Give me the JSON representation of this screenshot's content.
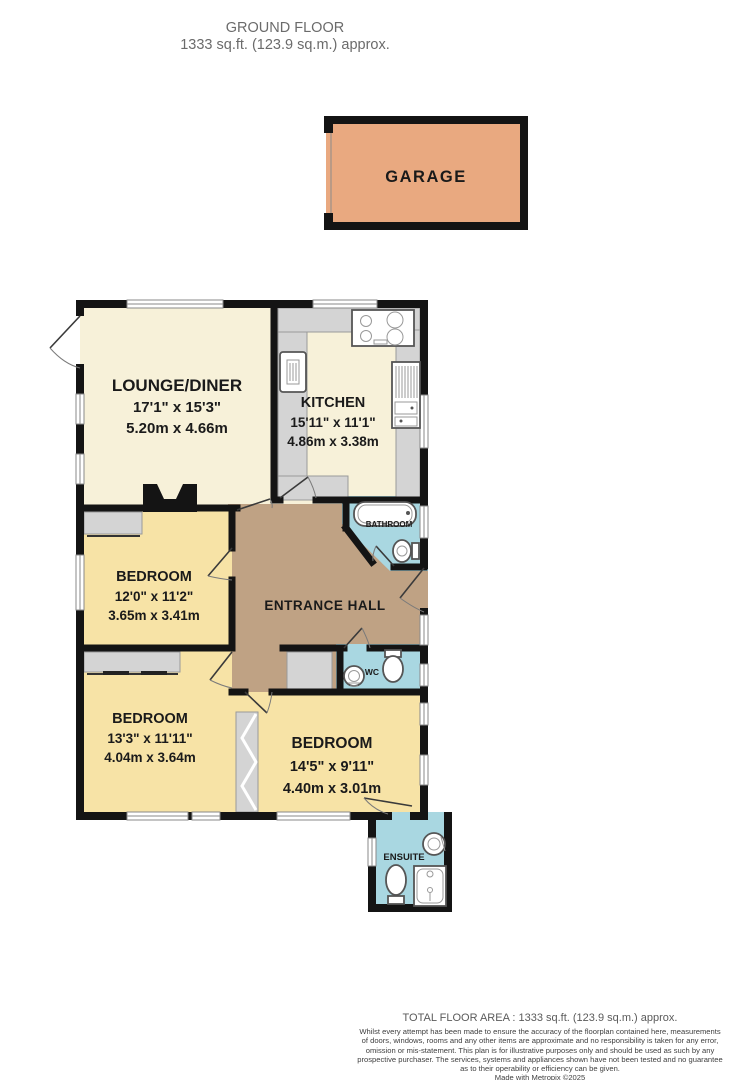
{
  "header": {
    "title": "GROUND FLOOR",
    "subtitle": "1333 sq.ft. (123.9 sq.m.) approx."
  },
  "garage": {
    "label": "GARAGE"
  },
  "rooms": {
    "lounge": {
      "name": "LOUNGE/DINER",
      "imperial": "17'1\" x 15'3\"",
      "metric": "5.20m x 4.66m"
    },
    "kitchen": {
      "name": "KITCHEN",
      "imperial": "15'11\" x 11'1\"",
      "metric": "4.86m x 3.38m"
    },
    "hall": {
      "name": "ENTRANCE HALL"
    },
    "bathroom": {
      "name": "BATHROOM"
    },
    "wc": {
      "name": "WC"
    },
    "ensuite": {
      "name": "ENSUITE"
    },
    "bedroom_mid": {
      "name": "BEDROOM",
      "imperial": "12'0\" x 11'2\"",
      "metric": "3.65m x 3.41m"
    },
    "bedroom_left": {
      "name": "BEDROOM",
      "imperial": "13'3\" x 11'11\"",
      "metric": "4.04m x 3.64m"
    },
    "bedroom_right": {
      "name": "BEDROOM",
      "imperial": "14'5\" x 9'11\"",
      "metric": "4.40m x 3.01m"
    }
  },
  "footer": {
    "total": "TOTAL FLOOR AREA : 1333 sq.ft. (123.9 sq.m.) approx.",
    "disclaimer": {
      "line1": "Whilst every attempt has been made to ensure the accuracy of the floorplan contained here, measurements",
      "line2": "of doors, windows, rooms and any other items are approximate and no responsibility is taken for any error,",
      "line3": "omission or mis-statement. This plan is for illustrative purposes only and should be used as such by any",
      "line4": "prospective purchaser. The services, systems and appliances shown have not been tested and no guarantee",
      "line5": "as to their operability or efficiency can be given.",
      "line6": "Made with Metropix ©2025"
    }
  },
  "colors": {
    "wall": "#141414",
    "cream": "#f7f1d9",
    "yellow": "#f7e3a6",
    "tan": "#bfa284",
    "blue": "#a9d7e1",
    "gray": "#d4d4d4",
    "garage": "#e9a980",
    "paper": "#ffffff"
  }
}
